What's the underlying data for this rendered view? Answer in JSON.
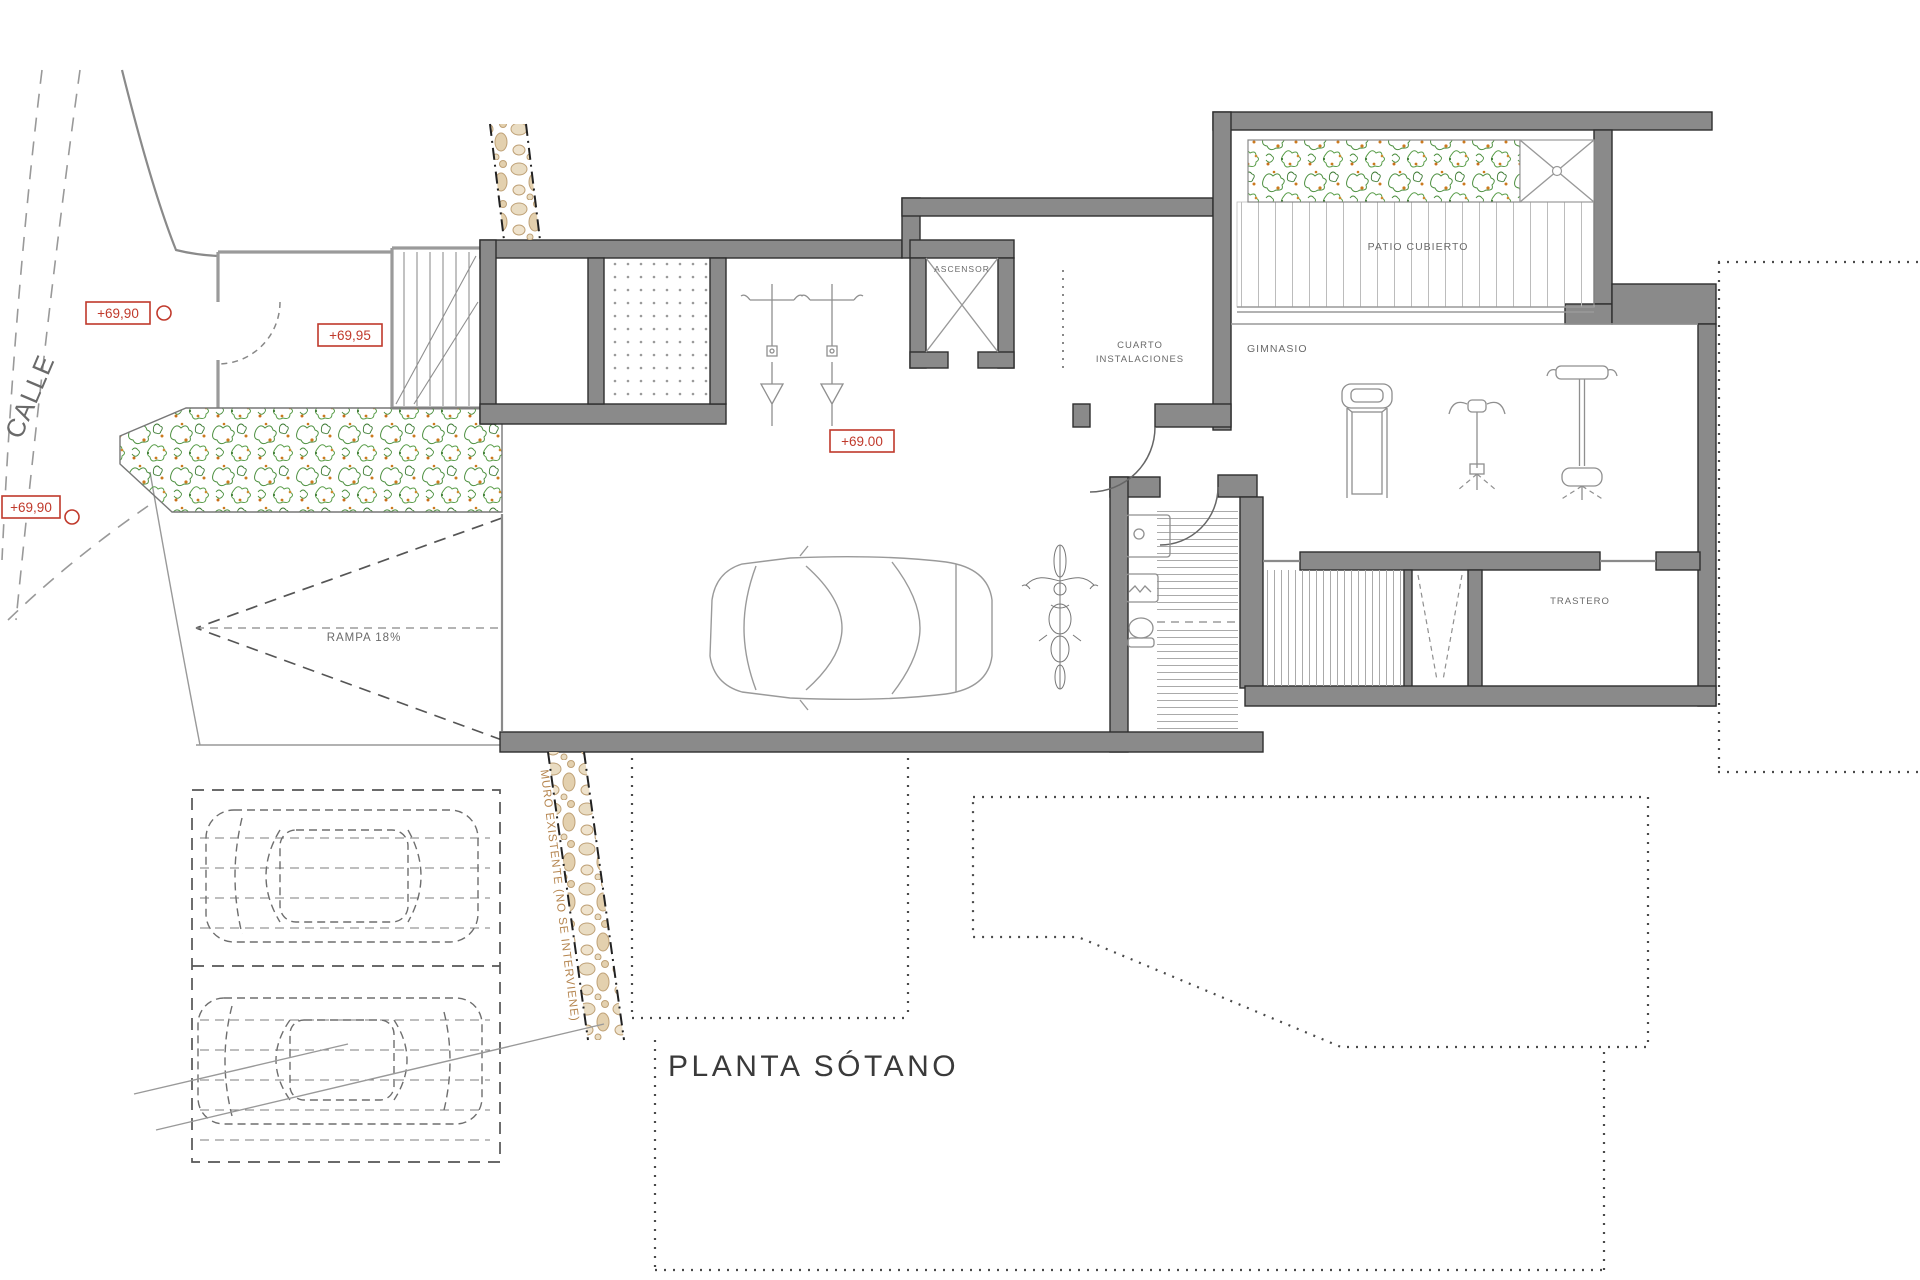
{
  "drawing": {
    "type": "architectural-floor-plan",
    "floor": "basement",
    "background": "#ffffff"
  },
  "labels": {
    "title": "PLANTA SÓTANO",
    "street": "CALLE",
    "elevator": "ASCENSOR",
    "utility_line1": "CUARTO",
    "utility_line2": "INSTALACIONES",
    "gym": "GIMNASIO",
    "patio": "PATIO CUBIERTO",
    "storage": "TRASTERO",
    "ramp": "RAMPA 18%",
    "wall_note": "MURO EXISTENTE (NO SE INTERVIENE)"
  },
  "elevations": {
    "street_upper": "+69,90",
    "entry_landing": "+69,95",
    "street_lower": "+69,90",
    "garage_floor": "+69.00"
  },
  "symbols": [
    "elevator-shaft-x",
    "stair-flight",
    "ramp-arrow",
    "garage-car",
    "motorcycle",
    "treadmill",
    "pec-deck-machine",
    "lat-tower-machine",
    "toilet",
    "washbasin",
    "laundry-sink",
    "shower-drain",
    "skylight-x",
    "floor-drain",
    "planter-vegetation",
    "existing-stone-wall",
    "parked-suv",
    "parked-sedan",
    "boundary-dotted-line"
  ],
  "colors": {
    "wall_fill": "#8a8a8a",
    "wall_stroke": "#2e2e2e",
    "elevation_red": "#c0392b",
    "plant_green": "#4c8f3f",
    "plant_orange": "#cc7a1f",
    "stone_beige": "#e9dcc2",
    "stone_edge": "#bfa176",
    "note_tan": "#b5854f",
    "line_gray": "#8f8f8f"
  }
}
